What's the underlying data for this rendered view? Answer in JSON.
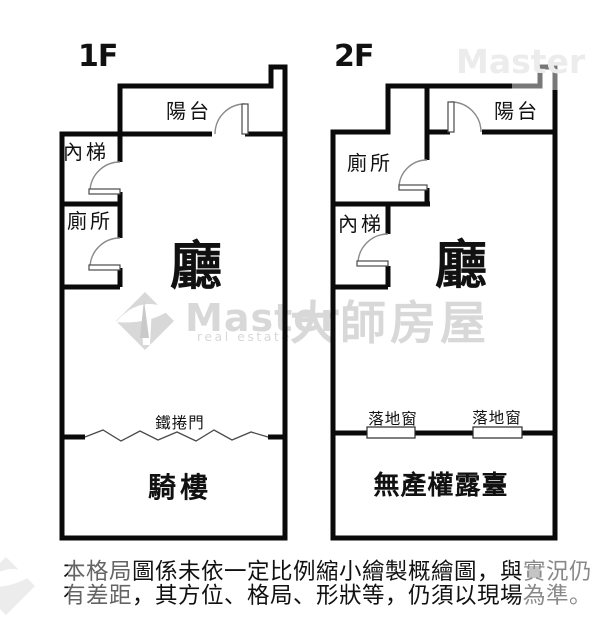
{
  "page": {
    "background": "#ffffff"
  },
  "colors": {
    "wall": "#0a0a0a",
    "text": "#111111",
    "door_arc": "#8a8a8a",
    "watermark": "#d8d8d8",
    "watermark_faint": "#ececec"
  },
  "floor1": {
    "label": "1F",
    "rooms": {
      "balcony": "陽台",
      "inner_stairs": "內梯",
      "toilet": "廁所",
      "hall": "廳",
      "arcade": "騎樓"
    },
    "roller_door": "鐵捲門"
  },
  "floor2": {
    "label": "2F",
    "rooms": {
      "balcony": "陽台",
      "toilet": "廁所",
      "inner_stairs": "內梯",
      "hall": "廳",
      "terrace": "無產權露臺"
    },
    "windows": {
      "left": "落地窗",
      "right": "落地窗"
    }
  },
  "watermark": {
    "brand": "Master",
    "tagline": "real estate",
    "brand_cjk": "大師房屋",
    "brand_faint": "Master"
  },
  "disclaimer": {
    "line1": "本格局圖係未依一定比例縮小繪製概繪圖，與實況仍",
    "line2": "有差距，其方位、格局、形狀等，仍須以現場為準。"
  }
}
